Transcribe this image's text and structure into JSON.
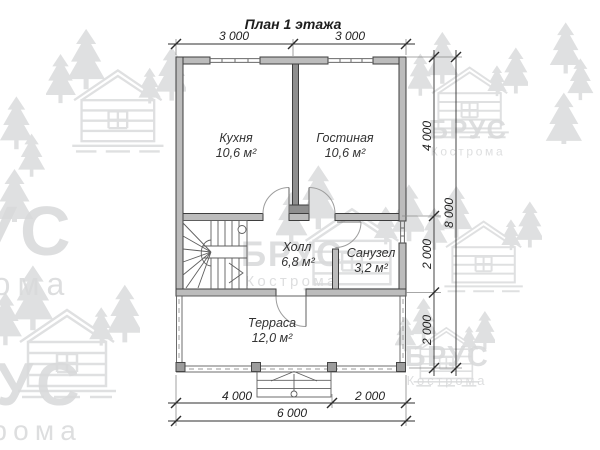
{
  "title": "План 1 этажа",
  "watermark": {
    "brand": "БРУС",
    "city": "Кострома"
  },
  "rooms": [
    {
      "name": "Кухня",
      "area": "10,6 м²"
    },
    {
      "name": "Гостиная",
      "area": "10,6 м²"
    },
    {
      "name": "Холл",
      "area": "6,8 м²"
    },
    {
      "name": "Санузел",
      "area": "3,2 м²"
    },
    {
      "name": "Терраса",
      "area": "12,0 м²"
    }
  ],
  "dimensions": {
    "top": [
      "3 000",
      "3 000"
    ],
    "right": [
      "4 000",
      "2 000",
      "2 000"
    ],
    "right_total": "8 000",
    "bottom": [
      "4 000",
      "2 000"
    ],
    "bottom_total": "6 000"
  },
  "colors": {
    "wall_fill": "#bcbcbc",
    "wall_stroke": "#3e3e3e",
    "partition_fill": "#8e8e8e",
    "thin_line": "#5f5f5f",
    "dim_color": "#2f2f2f",
    "watermark": "#d8d9da"
  }
}
